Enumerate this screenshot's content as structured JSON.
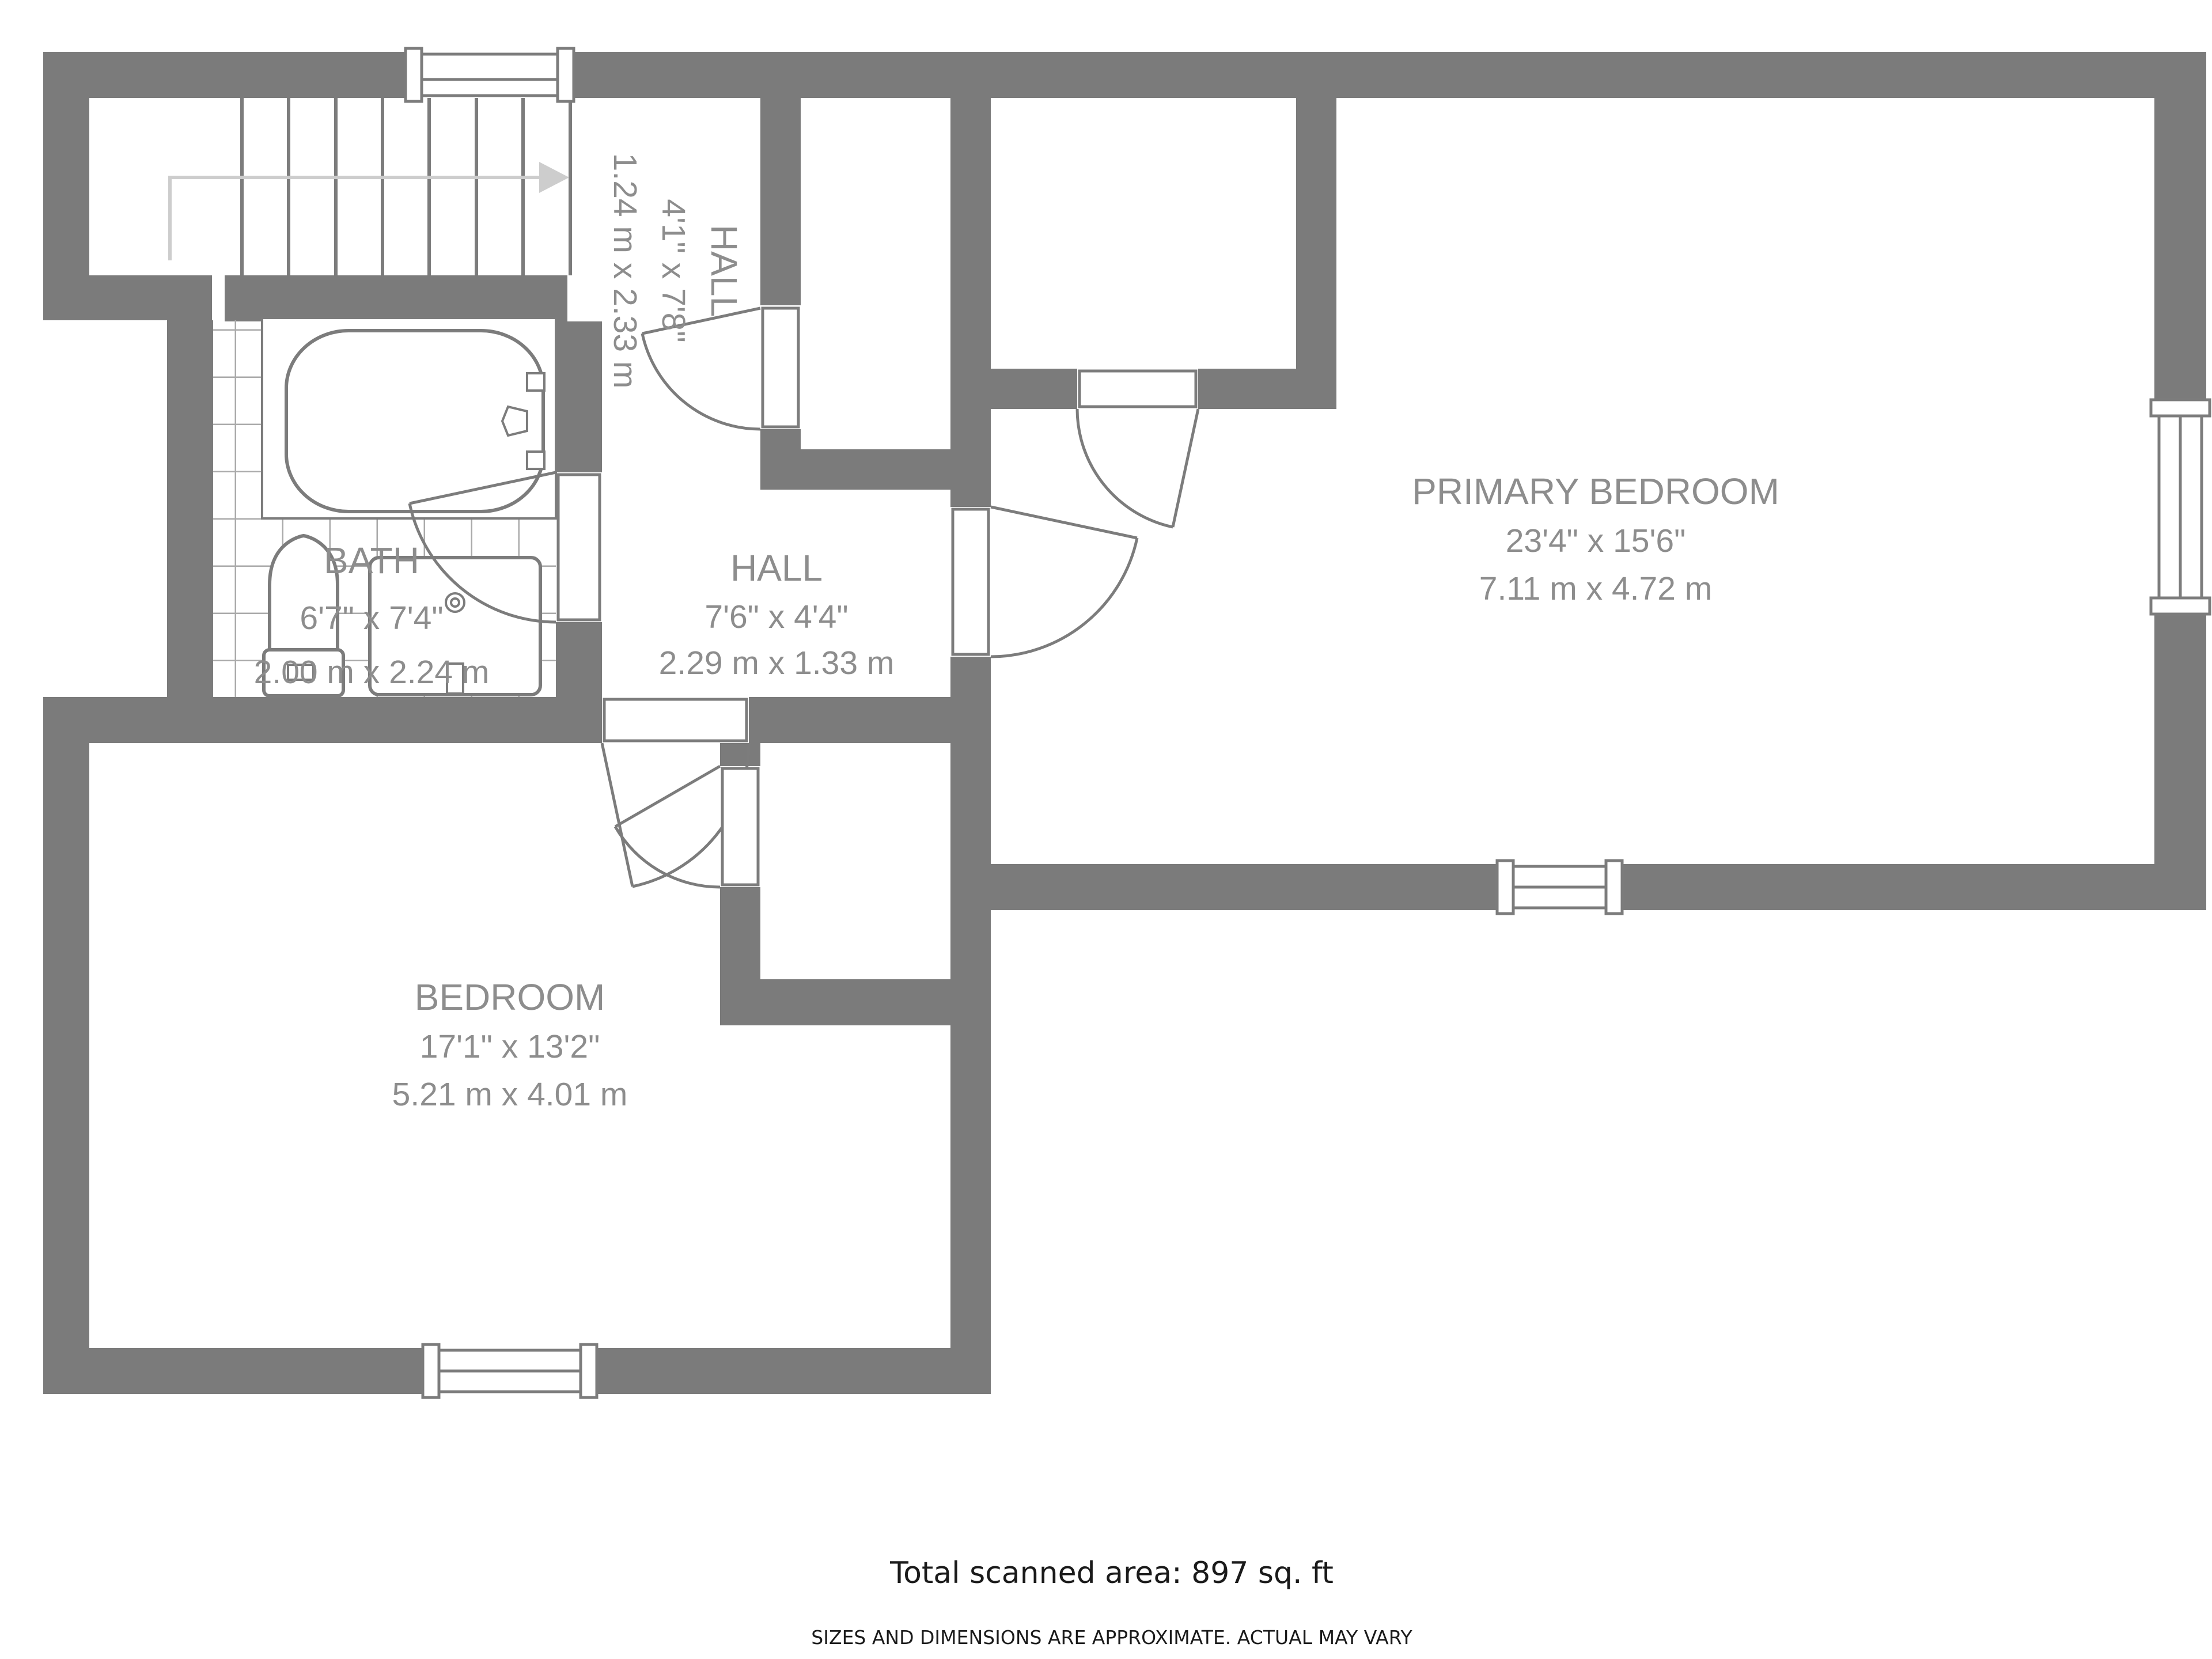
{
  "plan": {
    "rooms": {
      "landing_hall": {
        "name": "HALL",
        "dims_ft": "4'1\" x 7'8\"",
        "dims_m": "1.24 m x 2.33 m"
      },
      "bath": {
        "name": "BATH",
        "dims_ft": "6'7\" x 7'4\"",
        "dims_m": "2.00 m x 2.24 m"
      },
      "hall": {
        "name": "HALL",
        "dims_ft": "7'6\" x 4'4\"",
        "dims_m": "2.29 m x 1.33 m"
      },
      "primary_bedroom": {
        "name": "PRIMARY BEDROOM",
        "dims_ft": "23'4\" x 15'6\"",
        "dims_m": "7.11 m x 4.72 m"
      },
      "bedroom": {
        "name": "BEDROOM",
        "dims_ft": "17'1\" x 13'2\"",
        "dims_m": "5.21 m x 4.01 m"
      }
    },
    "footer": {
      "total_area": "Total scanned area: 897 sq. ft",
      "disclaimer": "SIZES AND DIMENSIONS ARE APPROXIMATE. ACTUAL MAY VARY"
    },
    "colors": {
      "wall": "#7b7b7b",
      "line": "#7c7c7c",
      "tile": "#aaaaaa",
      "arrow": "#cdcdcd",
      "label": "#8d8d8d",
      "footer": "#1a1a1a",
      "background": "#ffffff"
    }
  }
}
